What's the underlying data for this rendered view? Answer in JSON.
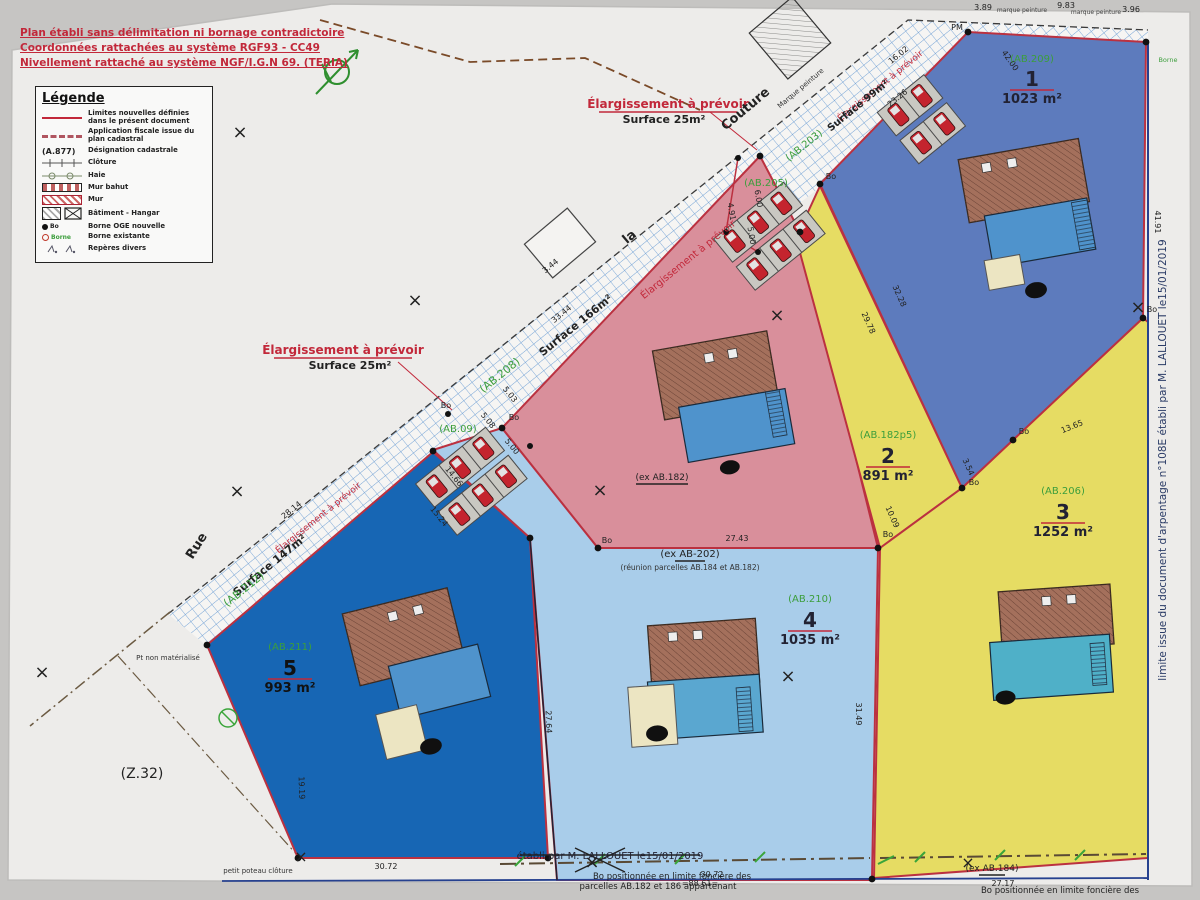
{
  "notes": [
    "Plan établi sans délimitation ni bornage contradictoire",
    "Coordonnées rattachées au système RGF93 - CC49",
    "Nivellement rattaché au système NGF/I.G.N 69. (TERIA)"
  ],
  "legend": {
    "title": "Légende",
    "items": [
      {
        "symbol": "new-limit-line",
        "label": "Limites nouvelles définies dans le présent document"
      },
      {
        "symbol": "fiscal-line",
        "label": "Application fiscale issue du plan cadastral"
      },
      {
        "symbol": "cadastral-ref",
        "symbol_text": "(A.877)",
        "label": "Désignation cadastrale"
      },
      {
        "symbol": "fence",
        "label": "Clôture"
      },
      {
        "symbol": "hedge",
        "label": "Haie"
      },
      {
        "symbol": "low-wall",
        "label": "Mur bahut"
      },
      {
        "symbol": "wall",
        "label": "Mur"
      },
      {
        "symbol": "building-hangar",
        "label": "Bâtiment - Hangar"
      },
      {
        "symbol": "new-marker",
        "symbol_text": "Bo",
        "label": "Borne OGE nouvelle"
      },
      {
        "symbol": "existing-marker",
        "symbol_text": "Borne",
        "label": "Borne existante"
      },
      {
        "symbol": "misc-marks",
        "label": "Repères divers"
      }
    ]
  },
  "colors": {
    "lot1": "#5d7bbd",
    "lot2": "#d98f9b",
    "lot3": "#e6dc63",
    "lot4": "#a9cdea",
    "lot5": "#1766b4",
    "boundary_new": "#bb3140",
    "cadastral_green": "#3c9e3c",
    "note_red": "#c2283a",
    "hatch_blue": "#74a3d6",
    "frame_blue": "#26418f",
    "paper": "#edecea"
  },
  "svg_texts": [
    {
      "n": "note-elargissement-top",
      "x": 668,
      "y": 108,
      "t": "Élargissement à prévoir",
      "s": 12,
      "c": "#c2283a",
      "w": 700,
      "ul": 1,
      "ulw": 138
    },
    {
      "n": "note-surface25-top",
      "x": 664,
      "y": 123,
      "t": "Surface 25m²",
      "s": 11,
      "c": "#222",
      "w": 700
    },
    {
      "n": "note-elargissement-left",
      "x": 343,
      "y": 354,
      "t": "Élargissement à prévoir",
      "s": 12,
      "c": "#c2283a",
      "w": 700,
      "ul": 1,
      "ulw": 138
    },
    {
      "n": "note-surface25-left",
      "x": 350,
      "y": 369,
      "t": "Surface 25m²",
      "s": 11,
      "c": "#222",
      "w": 700
    },
    {
      "n": "road-name-couture",
      "x": 748,
      "y": 112,
      "t": "Couture",
      "s": 13,
      "c": "#222",
      "r": -40,
      "w": 700
    },
    {
      "n": "road-name-la",
      "x": 632,
      "y": 240,
      "t": "la",
      "s": 13,
      "c": "#222",
      "r": -40,
      "w": 700
    },
    {
      "n": "road-name-rue",
      "x": 200,
      "y": 548,
      "t": "Rue",
      "s": 13,
      "c": "#222",
      "r": -58,
      "w": 700
    },
    {
      "n": "elargissement-diagonal",
      "x": 690,
      "y": 262,
      "t": "Élargissement à prévoir",
      "s": 10,
      "c": "#c2283a",
      "r": -39
    },
    {
      "n": "elargissement-diagonal",
      "x": 882,
      "y": 88,
      "t": "Élargissement à prévoir",
      "s": 9,
      "c": "#c2283a",
      "r": -39
    },
    {
      "n": "elargissement-diagonal",
      "x": 320,
      "y": 520,
      "t": "Élargissement à prévoir",
      "s": 9,
      "c": "#c2283a",
      "r": -39
    },
    {
      "n": "surface-166",
      "x": 578,
      "y": 328,
      "t": "Surface 166m²",
      "s": 11,
      "c": "#222",
      "r": -39,
      "w": 700
    },
    {
      "n": "surface-147",
      "x": 272,
      "y": 568,
      "t": "Surface 147m²",
      "s": 11,
      "c": "#222",
      "r": -39,
      "w": 700
    },
    {
      "n": "surface-99",
      "x": 860,
      "y": 108,
      "t": "Surface 99m²",
      "s": 10,
      "c": "#222",
      "r": -39,
      "w": 700
    },
    {
      "n": "ref-ab208",
      "x": 502,
      "y": 378,
      "t": "(AB.208)",
      "s": 11,
      "c": "#3c9e3c",
      "r": -39
    },
    {
      "n": "ref-ab212",
      "x": 246,
      "y": 592,
      "t": "(AB.212)",
      "s": 11,
      "c": "#3c9e3c",
      "r": -39
    },
    {
      "n": "ref-ab203",
      "x": 806,
      "y": 148,
      "t": "(AB.203)",
      "s": 10,
      "c": "#3c9e3c",
      "r": -39
    },
    {
      "n": "ref-ab205",
      "x": 766,
      "y": 186,
      "t": "(AB.205)",
      "s": 10,
      "c": "#3c9e3c"
    },
    {
      "n": "ref-ab09",
      "x": 458,
      "y": 432,
      "t": "(AB.09)",
      "s": 10,
      "c": "#3c9e3c"
    },
    {
      "n": "note-marque-peinture",
      "x": 802,
      "y": 90,
      "t": "Marque peinture",
      "s": 7,
      "c": "#333",
      "r": -40
    },
    {
      "n": "note-marque-peinture",
      "x": 1022,
      "y": 12,
      "t": "marque peinture",
      "s": 6,
      "c": "#444"
    },
    {
      "n": "note-marque-peinture",
      "x": 1096,
      "y": 14,
      "t": "marque peinture",
      "s": 6,
      "c": "#444"
    },
    {
      "n": "pm-mark",
      "x": 957,
      "y": 30,
      "t": "PM",
      "s": 8,
      "c": "#222"
    },
    {
      "n": "borne-label",
      "x": 1168,
      "y": 62,
      "t": "Borne",
      "s": 6.5,
      "c": "#3c9e3c"
    },
    {
      "n": "bo-label",
      "x": 831,
      "y": 179,
      "t": "Bo",
      "s": 8,
      "c": "#222"
    },
    {
      "n": "bo-label",
      "x": 974,
      "y": 485,
      "t": "Bo",
      "s": 8,
      "c": "#222"
    },
    {
      "n": "bo-label",
      "x": 1024,
      "y": 434,
      "t": "Bo",
      "s": 8,
      "c": "#222"
    },
    {
      "n": "bo-label",
      "x": 607,
      "y": 543,
      "t": "Bo",
      "s": 8,
      "c": "#222"
    },
    {
      "n": "bo-label",
      "x": 888,
      "y": 537,
      "t": "Bo",
      "s": 8,
      "c": "#222"
    },
    {
      "n": "bo-label",
      "x": 514,
      "y": 420,
      "t": "Bo",
      "s": 8,
      "c": "#222"
    },
    {
      "n": "bo-label",
      "x": 446,
      "y": 408,
      "t": "Bo",
      "s": 8,
      "c": "#222"
    },
    {
      "n": "bo-label",
      "x": 1152,
      "y": 312,
      "t": "Bo",
      "s": 8,
      "c": "#222"
    },
    {
      "n": "measure",
      "x": 552,
      "y": 268,
      "t": "3.44",
      "s": 8,
      "r": -39
    },
    {
      "n": "measure",
      "x": 563,
      "y": 316,
      "t": "33.44",
      "s": 8,
      "r": -39
    },
    {
      "n": "measure",
      "x": 293,
      "y": 512,
      "t": "28.14",
      "s": 8,
      "r": -39
    },
    {
      "n": "measure",
      "x": 452,
      "y": 478,
      "t": "14.66",
      "s": 8,
      "r": 51
    },
    {
      "n": "measure",
      "x": 437,
      "y": 518,
      "t": "15.24",
      "s": 8,
      "r": 51
    },
    {
      "n": "measure",
      "x": 508,
      "y": 396,
      "t": "5.03",
      "s": 8,
      "r": 51
    },
    {
      "n": "measure",
      "x": 486,
      "y": 422,
      "t": "5.08",
      "s": 8,
      "r": 51
    },
    {
      "n": "measure",
      "x": 510,
      "y": 448,
      "t": "5.00",
      "s": 8,
      "r": 51
    },
    {
      "n": "measure",
      "x": 756,
      "y": 199,
      "t": "6.00",
      "s": 8,
      "r": 80
    },
    {
      "n": "measure",
      "x": 729,
      "y": 212,
      "t": "4.91",
      "s": 8,
      "r": 80
    },
    {
      "n": "measure",
      "x": 749,
      "y": 236,
      "t": "5.00",
      "s": 8,
      "r": 80
    },
    {
      "n": "measure",
      "x": 900,
      "y": 57,
      "t": "16.02",
      "s": 8,
      "r": -39
    },
    {
      "n": "measure",
      "x": 899,
      "y": 100,
      "t": "23.26",
      "s": 8,
      "r": -39
    },
    {
      "n": "measure",
      "x": 1008,
      "y": 62,
      "t": "42.00",
      "s": 8,
      "r": 55
    },
    {
      "n": "measure",
      "x": 897,
      "y": 297,
      "t": "32.28",
      "s": 8,
      "r": 66
    },
    {
      "n": "measure",
      "x": 866,
      "y": 324,
      "t": "29.78",
      "s": 8,
      "r": 66
    },
    {
      "n": "measure",
      "x": 966,
      "y": 468,
      "t": "3.54",
      "s": 8,
      "r": 66
    },
    {
      "n": "measure",
      "x": 890,
      "y": 518,
      "t": "10.09",
      "s": 8,
      "r": 66
    },
    {
      "n": "measure",
      "x": 1073,
      "y": 429,
      "t": "13.65",
      "s": 8,
      "r": -22
    },
    {
      "n": "measure",
      "x": 1155,
      "y": 222,
      "t": "41.91",
      "s": 8,
      "r": 90
    },
    {
      "n": "measure",
      "x": 737,
      "y": 541,
      "t": "27.43",
      "s": 8
    },
    {
      "n": "measure",
      "x": 856,
      "y": 714,
      "t": "31.49",
      "s": 8,
      "r": 90
    },
    {
      "n": "measure",
      "x": 546,
      "y": 722,
      "t": "27.64",
      "s": 8,
      "r": 88
    },
    {
      "n": "measure",
      "x": 386,
      "y": 869,
      "t": "30.72",
      "s": 8
    },
    {
      "n": "measure",
      "x": 712,
      "y": 877,
      "t": "30.72",
      "s": 8
    },
    {
      "n": "measure",
      "x": 1003,
      "y": 886,
      "t": "27.17",
      "s": 8
    },
    {
      "n": "measure",
      "x": 299,
      "y": 788,
      "t": "19.19",
      "s": 8,
      "r": 88
    },
    {
      "n": "measure",
      "x": 983,
      "y": 10,
      "t": "3.89",
      "s": 8
    },
    {
      "n": "measure",
      "x": 1066,
      "y": 8,
      "t": "9.83",
      "s": 8
    },
    {
      "n": "measure",
      "x": 1131,
      "y": 12,
      "t": "3.96",
      "s": 8
    },
    {
      "n": "level-mark",
      "x": 700,
      "y": 886,
      "t": "=88.61=",
      "s": 8
    },
    {
      "n": "ref-ex-ab182",
      "x": 662,
      "y": 480,
      "t": "(ex AB.182)",
      "s": 9,
      "c": "#222",
      "ul": 1,
      "ulw": 52
    },
    {
      "n": "ref-ex-ab202",
      "x": 690,
      "y": 557,
      "t": "(ex AB-202)",
      "s": 10,
      "c": "#222",
      "ul": 1,
      "ulw": 30
    },
    {
      "n": "note-reunion",
      "x": 690,
      "y": 570,
      "t": "(réunion parcelles AB.184 et AB.182)",
      "s": 7.5,
      "c": "#333"
    },
    {
      "n": "ref-ex-ab184",
      "x": 992,
      "y": 871,
      "t": "(ex AB.184)",
      "s": 9,
      "c": "#222",
      "ul": 1,
      "ulw": 26
    },
    {
      "n": "ref-z32",
      "x": 142,
      "y": 778,
      "t": "(Z.32)",
      "s": 14,
      "c": "#222"
    },
    {
      "n": "note-pt-non-materialise",
      "x": 168,
      "y": 660,
      "t": "Pt non matérialisé",
      "s": 7,
      "c": "#333"
    },
    {
      "n": "note-petit-poteau",
      "x": 258,
      "y": 873,
      "t": "petit poteau clôture",
      "s": 7,
      "c": "#333"
    },
    {
      "n": "note-bo-position-1",
      "x": 672,
      "y": 879,
      "t": "Bo positionnée en limite foncière des",
      "s": 8.5,
      "c": "#222"
    },
    {
      "n": "note-bo-position-1b",
      "x": 658,
      "y": 889,
      "t": "parcelles AB.182 et 186 appartenant",
      "s": 8.5,
      "c": "#222"
    },
    {
      "n": "note-bo-position-2",
      "x": 1060,
      "y": 893,
      "t": "Bo positionnée en limite foncière des",
      "s": 8.5,
      "c": "#222"
    },
    {
      "n": "note-etabli",
      "x": 610,
      "y": 859,
      "t": "établi par M. LALLOUET le15/01/2019",
      "s": 10,
      "c": "#223"
    },
    {
      "n": "margin-right-note",
      "x": 1166,
      "y": 460,
      "t": "limite issue du document d'arpentage n°108E établi par M. LALLOUET le15/01/2019",
      "s": 10.5,
      "c": "#2a3b66",
      "r": -90
    },
    {
      "n": "x-mark",
      "x": 240,
      "y": 138,
      "t": "×",
      "s": 18,
      "c": "#222"
    },
    {
      "n": "x-mark",
      "x": 415,
      "y": 306,
      "t": "×",
      "s": 18,
      "c": "#222"
    },
    {
      "n": "x-mark",
      "x": 42,
      "y": 678,
      "t": "×",
      "s": 18,
      "c": "#222"
    },
    {
      "n": "x-mark",
      "x": 237,
      "y": 497,
      "t": "×",
      "s": 18,
      "c": "#222"
    },
    {
      "n": "x-mark",
      "x": 600,
      "y": 496,
      "t": "×",
      "s": 18,
      "c": "#222"
    },
    {
      "n": "x-mark",
      "x": 777,
      "y": 321,
      "t": "×",
      "s": 18,
      "c": "#222"
    },
    {
      "n": "x-mark",
      "x": 788,
      "y": 682,
      "t": "×",
      "s": 18,
      "c": "#222"
    },
    {
      "n": "x-mark",
      "x": 1138,
      "y": 313,
      "t": "×",
      "s": 18,
      "c": "#222"
    },
    {
      "n": "x-mark",
      "x": 592,
      "y": 868,
      "t": "×",
      "s": 18,
      "c": "#222"
    },
    {
      "n": "x-mark",
      "x": 968,
      "y": 868,
      "t": "×",
      "s": 16,
      "c": "#222"
    },
    {
      "n": "x-mark",
      "x": 301,
      "y": 862,
      "t": "×",
      "s": 16,
      "c": "#222"
    },
    {
      "n": "lot1-ref",
      "x": 1032,
      "y": 62,
      "t": "(AB.209)",
      "s": 10,
      "c": "#3c9e3c"
    },
    {
      "n": "lot1-number",
      "x": 1032,
      "y": 86,
      "t": "1",
      "s": 20,
      "c": "#223",
      "w": 700,
      "ul": 1,
      "ulw": 44,
      "ulc": "#c2283a"
    },
    {
      "n": "lot1-area",
      "x": 1032,
      "y": 103,
      "t": "1023 m²",
      "s": 13,
      "c": "#223",
      "w": 700
    },
    {
      "n": "lot2-ref",
      "x": 888,
      "y": 438,
      "t": "(AB.182p5)",
      "s": 10,
      "c": "#3c9e3c"
    },
    {
      "n": "lot2-number",
      "x": 888,
      "y": 463,
      "t": "2",
      "s": 20,
      "c": "#223",
      "w": 700,
      "ul": 1,
      "ulw": 44,
      "ulc": "#c2283a"
    },
    {
      "n": "lot2-area",
      "x": 888,
      "y": 480,
      "t": "891 m²",
      "s": 13,
      "c": "#223",
      "w": 700
    },
    {
      "n": "lot3-ref",
      "x": 1063,
      "y": 494,
      "t": "(AB.206)",
      "s": 10,
      "c": "#3c9e3c"
    },
    {
      "n": "lot3-number",
      "x": 1063,
      "y": 519,
      "t": "3",
      "s": 20,
      "c": "#223",
      "w": 700,
      "ul": 1,
      "ulw": 44,
      "ulc": "#c2283a"
    },
    {
      "n": "lot3-area",
      "x": 1063,
      "y": 536,
      "t": "1252 m²",
      "s": 13,
      "c": "#223",
      "w": 700
    },
    {
      "n": "lot4-ref",
      "x": 810,
      "y": 602,
      "t": "(AB.210)",
      "s": 10,
      "c": "#3c9e3c"
    },
    {
      "n": "lot4-number",
      "x": 810,
      "y": 627,
      "t": "4",
      "s": 20,
      "c": "#223",
      "w": 700,
      "ul": 1,
      "ulw": 44,
      "ulc": "#c2283a"
    },
    {
      "n": "lot4-area",
      "x": 810,
      "y": 644,
      "t": "1035 m²",
      "s": 13,
      "c": "#223",
      "w": 700
    },
    {
      "n": "lot5-ref",
      "x": 290,
      "y": 650,
      "t": "(AB.211)",
      "s": 10,
      "c": "#3c9e3c"
    },
    {
      "n": "lot5-number",
      "x": 290,
      "y": 675,
      "t": "5",
      "s": 20,
      "c": "#111",
      "w": 700,
      "ul": 1,
      "ulw": 44,
      "ulc": "#c2283a"
    },
    {
      "n": "lot5-area",
      "x": 290,
      "y": 692,
      "t": "993 m²",
      "s": 13,
      "c": "#111",
      "w": 700
    }
  ]
}
